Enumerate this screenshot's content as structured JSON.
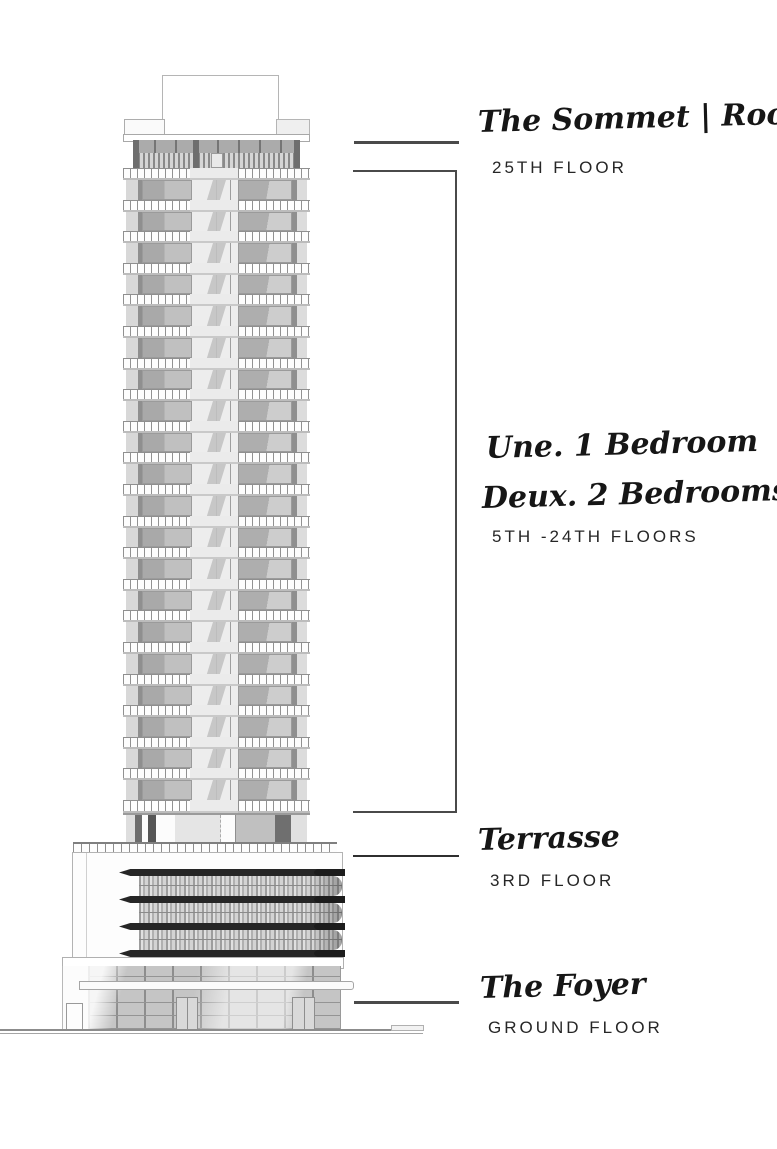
{
  "diagram_title": "Residential tower elevation with floor annotations",
  "palette": {
    "ink": "#161616",
    "leader_line": "#4a4a4a",
    "glass_gray": "#c5c5c5",
    "panel_gray": "#aeaeae",
    "dark_band": "#262626",
    "background": "#ffffff"
  },
  "annotations": {
    "sommet": {
      "script": "The Sommet | Rooftop",
      "floor": "25TH FLOOR"
    },
    "units": {
      "script_line1": "Une. 1 Bedroom",
      "script_line2": "Deux. 2 Bedrooms",
      "floor": "5TH -24TH FLOORS"
    },
    "terrasse": {
      "script": "Terrasse",
      "floor": "3RD FLOOR"
    },
    "foyer": {
      "script": "The Foyer",
      "floor": "GROUND FLOOR"
    }
  },
  "building": {
    "tower_floor_count": 20,
    "podium_band_count": 4,
    "podium_screen_rows": 3,
    "podium_band_tops": [
      16,
      43,
      70,
      97
    ],
    "podium_screen_tops": [
      23,
      50,
      77
    ]
  }
}
